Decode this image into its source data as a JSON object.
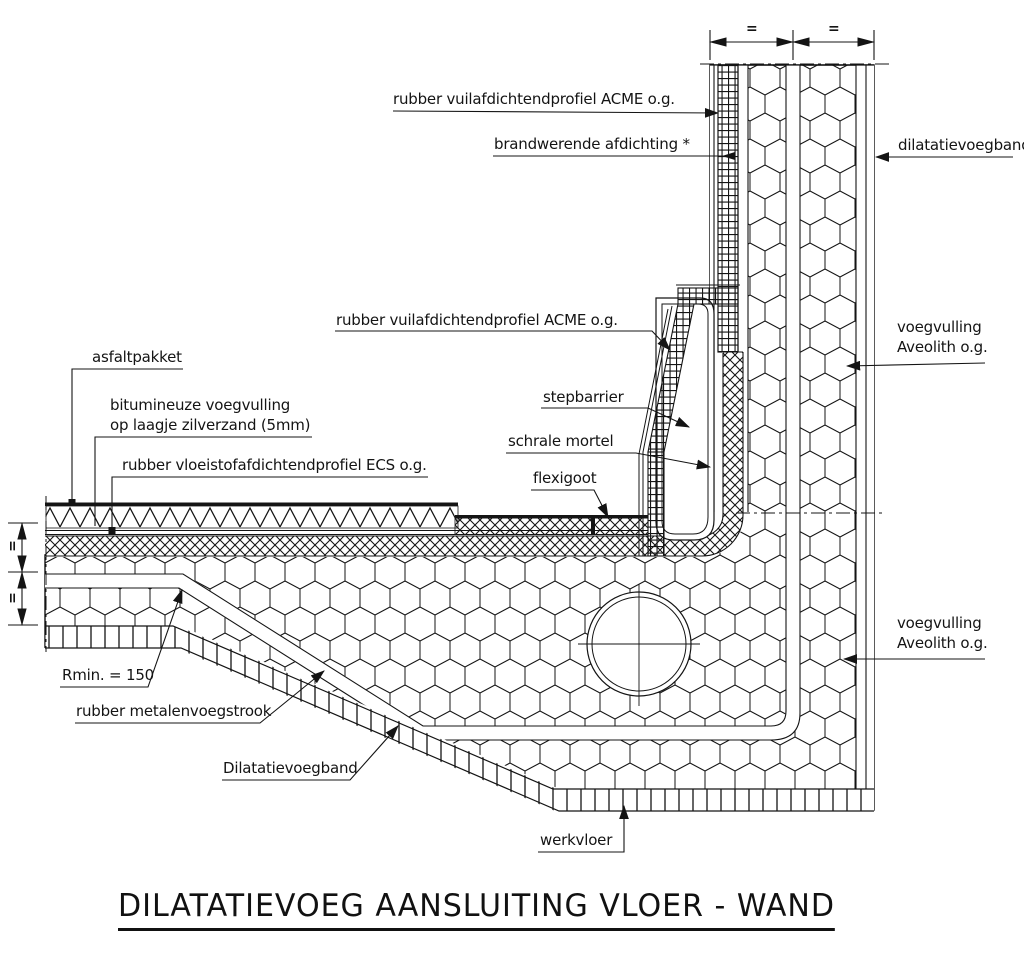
{
  "title": "DILATATIEVOEG AANSLUITING VLOER - WAND",
  "labels": {
    "rubber_profiel_acme_top": "rubber vuilafdichtendprofiel ACME o.g.",
    "brandwerende_afdichting": "brandwerende afdichting *",
    "dilatatievoegband_wand": "dilatatievoegband",
    "rubber_profiel_acme_mid": "rubber vuilafdichtendprofiel ACME o.g.",
    "voegvulling_boven": "voegvulling\nAveolith o.g.",
    "asfaltpakket": "asfaltpakket",
    "bitumineuze_voegvulling": "bitumineuze voegvulling\nop laagje zilverzand (5mm)",
    "rubber_profiel_ecs": "rubber vloeistofafdichtendprofiel ECS o.g.",
    "stepbarrier": "stepbarrier",
    "schrale_mortel": "schrale mortel",
    "flexigoot": "flexigoot",
    "voegvulling_onder": "voegvulling\nAveolith o.g.",
    "rmin": "Rmin. = 150",
    "metalenvoegstrook": "rubber metalenvoegstrook",
    "dilatatievoegband_vloer": "Dilatatievoegband",
    "werkvloer": "werkvloer"
  },
  "dimensions": {
    "top_span_left": "=",
    "top_span_right": "=",
    "left_span_upper": "=",
    "left_span_lower": "="
  },
  "colors": {
    "ink": "#141414",
    "background": "#ffffff"
  }
}
